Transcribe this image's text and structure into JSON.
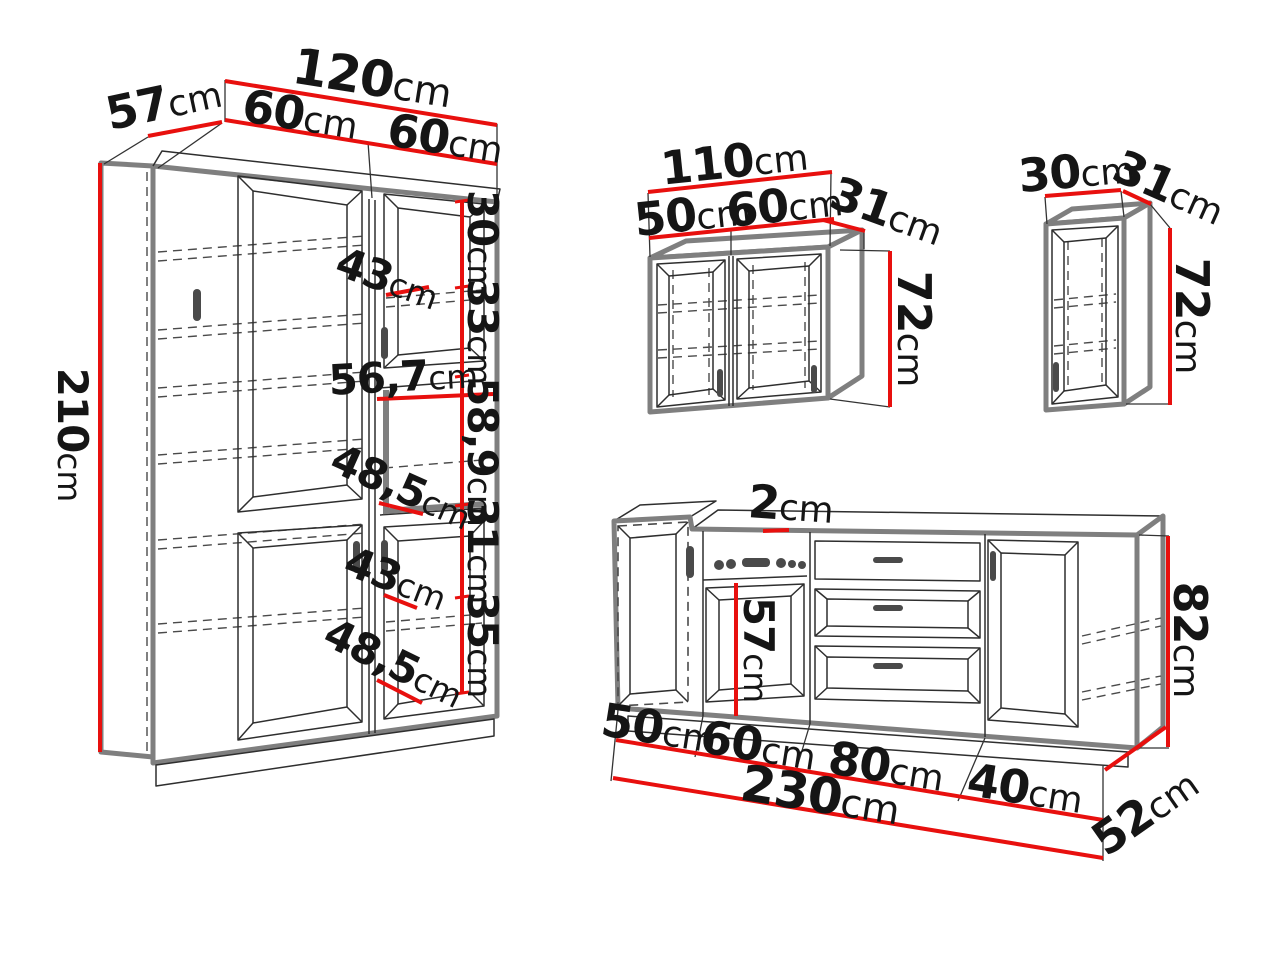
{
  "unit": "cm",
  "colors": {
    "dimension_red": "#e8100e",
    "drawing_ink": "#2e2e2e",
    "carcass_gray": "#7f7f7f",
    "background": "#ffffff"
  },
  "tall_cabinet": {
    "height": "210",
    "depth": "57",
    "width_total": "120",
    "left_door_width": "60",
    "right_door_width": "60",
    "top_shelf_height": "30",
    "upper_door_height": "33",
    "upper_shelf_depth": "43",
    "niche_width": "56,7",
    "niche_height": "58,9",
    "niche_shelf_depth": "48,5",
    "lower_shelf_height": "31",
    "lower_door_height": "35",
    "lower_shelf_depth": "43",
    "base_shelf_depth": "48,5"
  },
  "wall_cabinet_double": {
    "width_total": "110",
    "left_door_width": "50",
    "right_door_width": "60",
    "depth": "31",
    "height": "72"
  },
  "wall_cabinet_single": {
    "width": "30",
    "depth": "31",
    "height": "72"
  },
  "base_unit": {
    "worktop_thickness": "2",
    "oven_door_height": "57",
    "height": "82",
    "section_widths": [
      "50",
      "60",
      "80",
      "40"
    ],
    "width_total": "230",
    "depth": "52"
  }
}
